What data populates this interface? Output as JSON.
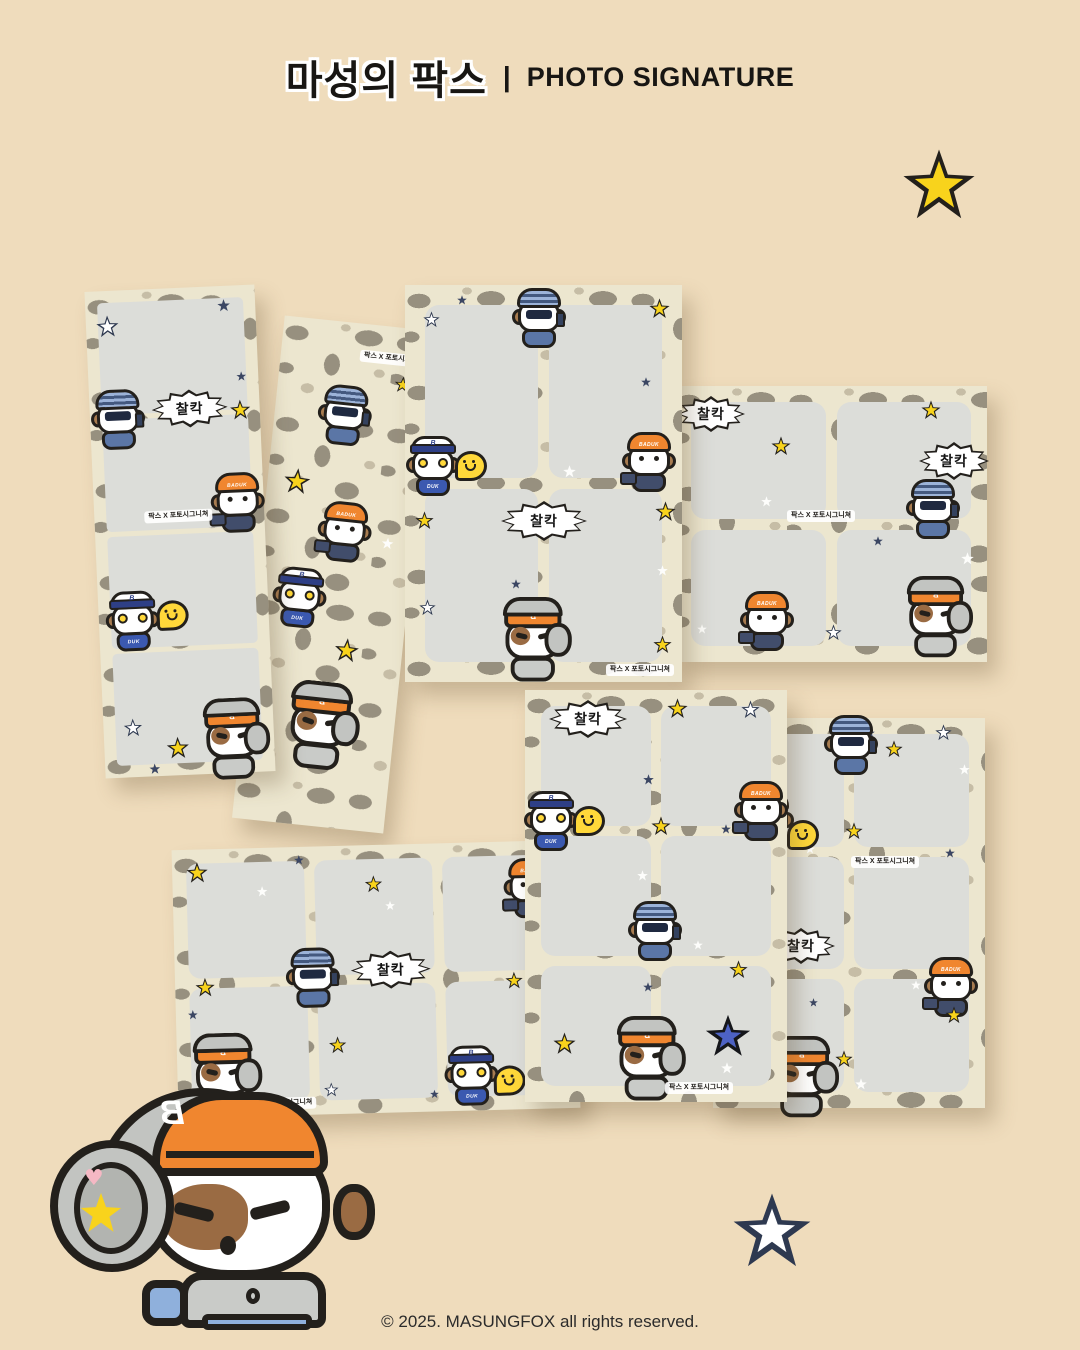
{
  "page": {
    "width": 1080,
    "height": 1350,
    "background": "#efdcbc",
    "title": {
      "ko": "마성의 팍스",
      "separator": "|",
      "en": "PHOTO SIGNATURE"
    },
    "copyright": "© 2025. MASUNGFOX all rights reserved."
  },
  "labels": {
    "shutter_bubble": "찰칵",
    "collab": "팍스 X 포토시그니쳐",
    "baduk_hat": "BADUK",
    "duk_shirt": "DUK",
    "cap_letter": "B"
  },
  "colors": {
    "background": "#efdcbc",
    "leopard_base": "#ece6cf",
    "leopard_spot": "#97907f",
    "leopard_spot_light": "#c6bda6",
    "photo_cell": "#dcddd9",
    "outline": "#23201c",
    "star_yellow": "#f8d31c",
    "star_navy": "#2e3950",
    "star_blue": "#4d62c4",
    "orange": "#f0862f",
    "steel_blue": "#5b76a6"
  },
  "products": [
    {
      "name": "photo strip back (leopard pattern)",
      "cells": 0
    },
    {
      "name": "4-cut photo strip front",
      "cells": 4
    },
    {
      "name": "4-cut frame portrait",
      "cells": 4
    },
    {
      "name": "4-cut frame landscape",
      "cells": 4
    },
    {
      "name": "6-cut frame portrait",
      "cells": 6
    },
    {
      "name": "6-cut frame portrait second",
      "cells": 6
    },
    {
      "name": "6-cut frame landscape",
      "cells": 6
    }
  ],
  "characters": [
    {
      "id": "beanie-dog",
      "desc": "dog in striped blue beanie taking phone photo"
    },
    {
      "id": "baduk-dog",
      "desc": "dog in orange BADUK beanie holding camera"
    },
    {
      "id": "duk-dog",
      "desc": "dog in white cap with yellow sunglasses"
    },
    {
      "id": "headphone-dog",
      "desc": "dog in backwards orange cap with headphones"
    }
  ]
}
